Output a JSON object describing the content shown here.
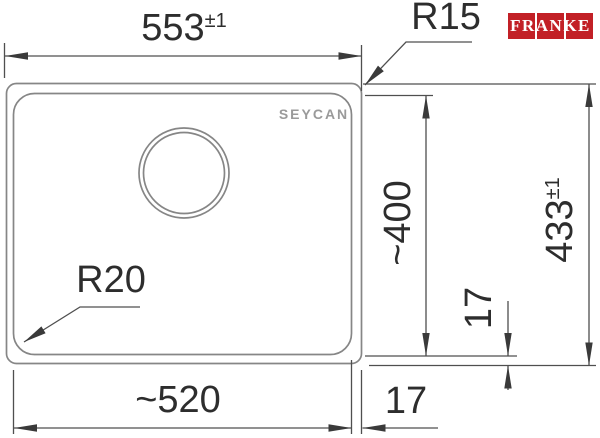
{
  "drawing": {
    "type": "sink-technical-drawing",
    "background": "#ffffff",
    "outline_color": "#868686",
    "dimension_line_color": "#4f4f4f",
    "text_color": "#2d2d2d"
  },
  "brand": {
    "logo_text": "FRANKE",
    "logo_bg_color": "#c22026",
    "logo_text_color": "#ffffff"
  },
  "watermark": {
    "text": "SEYCAN",
    "color": "#9a9a9a"
  },
  "dimensions": {
    "outer_width": {
      "value": "553",
      "tolerance": "±1"
    },
    "corner_radius_top_right": {
      "label": "R15"
    },
    "corner_radius_bottom_left": {
      "label": "R20"
    },
    "inner_depth": {
      "value": "~400"
    },
    "outer_depth": {
      "value": "433",
      "tolerance": "±1"
    },
    "rim_gap_vertical": {
      "value": "17"
    },
    "inner_width": {
      "value": "~520"
    },
    "rim_gap_horizontal": {
      "value": "17"
    }
  }
}
